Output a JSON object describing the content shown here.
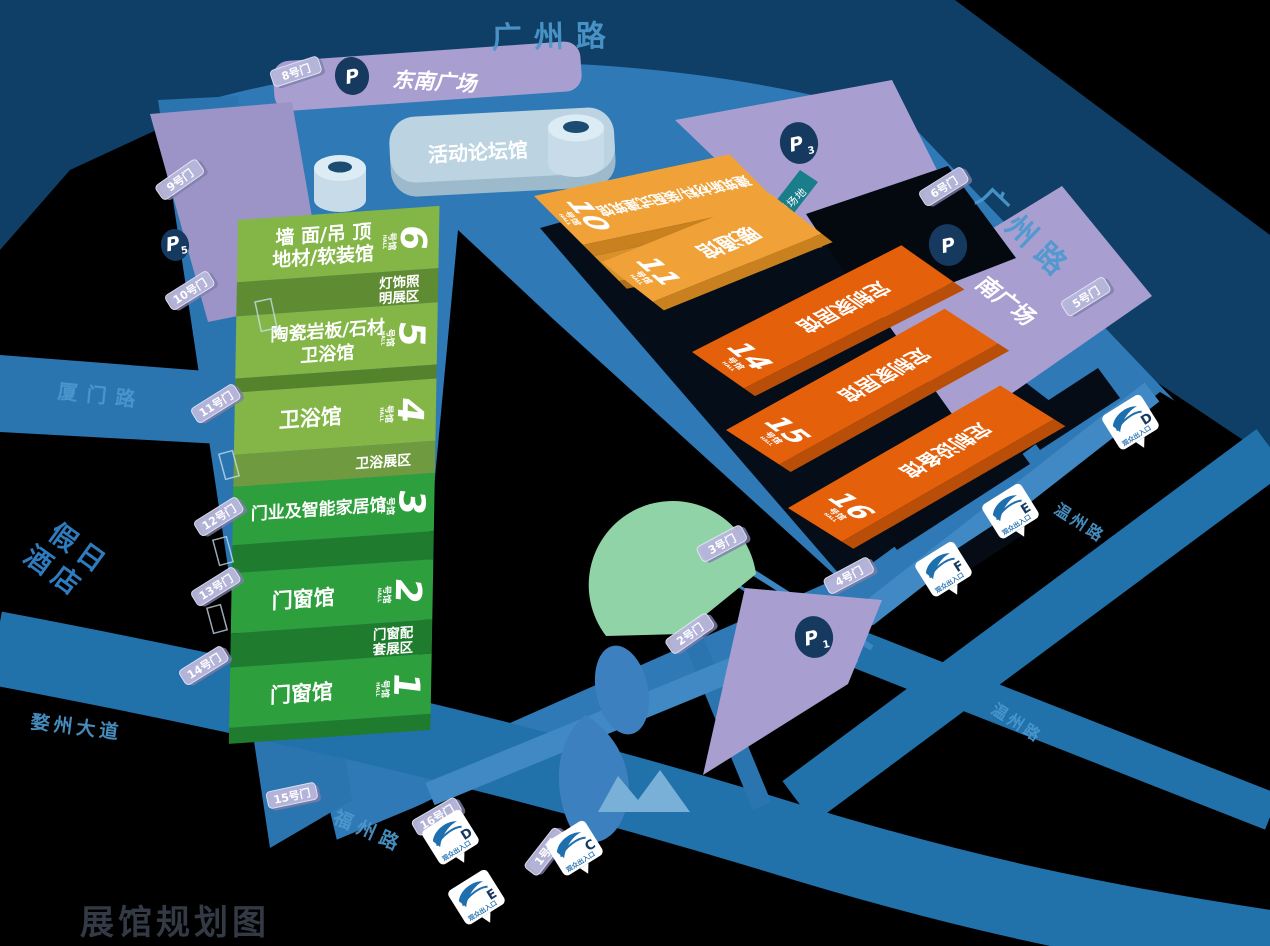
{
  "map_title": "展馆规划图",
  "labels": {
    "hall_suffix": "号馆",
    "hall_suffix_en": "HALL"
  },
  "roads": {
    "guangzhou_top": "广州路",
    "guangzhou_right": "广州路",
    "xiamen": "厦门路",
    "wuzhou_avenue": "婺州大道",
    "fuzhou": "福州路",
    "wenzhou_upper": "温州路",
    "wenzhou_lower": "温州路"
  },
  "plazas": {
    "southeast": "东南广场",
    "south": "南广场"
  },
  "hotel": {
    "line1": "假日",
    "line2": "酒店"
  },
  "fire_lane": "消防救援场地",
  "forum_hall": {
    "name": "活动论坛馆",
    "num": "9"
  },
  "green_halls": [
    {
      "num": "6",
      "line1": "墙 面/吊 顶",
      "line2": "地材/软装馆"
    },
    {
      "num": "5",
      "line1": "陶瓷岩板/石材",
      "line2": "卫浴馆"
    },
    {
      "num": "4",
      "line1": "卫浴馆",
      "line2": ""
    },
    {
      "num": "3",
      "line1": "门业及智能家居馆",
      "line2": ""
    },
    {
      "num": "2",
      "line1": "门窗馆",
      "line2": ""
    },
    {
      "num": "1",
      "line1": "门窗馆",
      "line2": ""
    }
  ],
  "green_zones": {
    "lighting_l1": "灯饰照",
    "lighting_l2": "明展区",
    "bath": "卫浴展区",
    "window_l1": "门窗配",
    "window_l2": "套展区"
  },
  "orange_halls": [
    {
      "num": "10",
      "name": "建筑新材料/装配式建筑馆"
    },
    {
      "num": "11",
      "name": "暖通馆"
    },
    {
      "num": "14",
      "name": "定制家居馆"
    },
    {
      "num": "15",
      "name": "定制家居馆"
    },
    {
      "num": "16",
      "name": "定制设备馆"
    }
  ],
  "orange_zones": {
    "kitchen": "厨电展区"
  },
  "gates": {
    "g1": "1号门",
    "g2": "2号门",
    "g3": "3号门",
    "g4": "4号门",
    "g5": "5号门",
    "g6": "6号门",
    "g8": "8号门",
    "g9": "9号门",
    "g10": "10号门",
    "g11": "11号门",
    "g12": "12号门",
    "g13": "13号门",
    "g14": "14号门",
    "g15": "15号门",
    "g16": "16号门"
  },
  "parkings": {
    "p": "P",
    "p1_sub": "1",
    "p3_sub": "3",
    "p5_sub": "5"
  },
  "entrances": {
    "label": "观众出入口",
    "letters": [
      "D",
      "E",
      "C",
      "D",
      "E",
      "F"
    ]
  },
  "colors": {
    "green_light": "#83b646",
    "green_dark": "#2d9f3d",
    "orange_light": "#f0a238",
    "orange_dark": "#e4600a",
    "purple": "#a89fd0",
    "navy": "#0f3f66",
    "plaza_blue": "#2e79b6",
    "road_blue": "#2171ab",
    "teal": "#1a7d8a",
    "marker_blue": "#1e6fae"
  }
}
